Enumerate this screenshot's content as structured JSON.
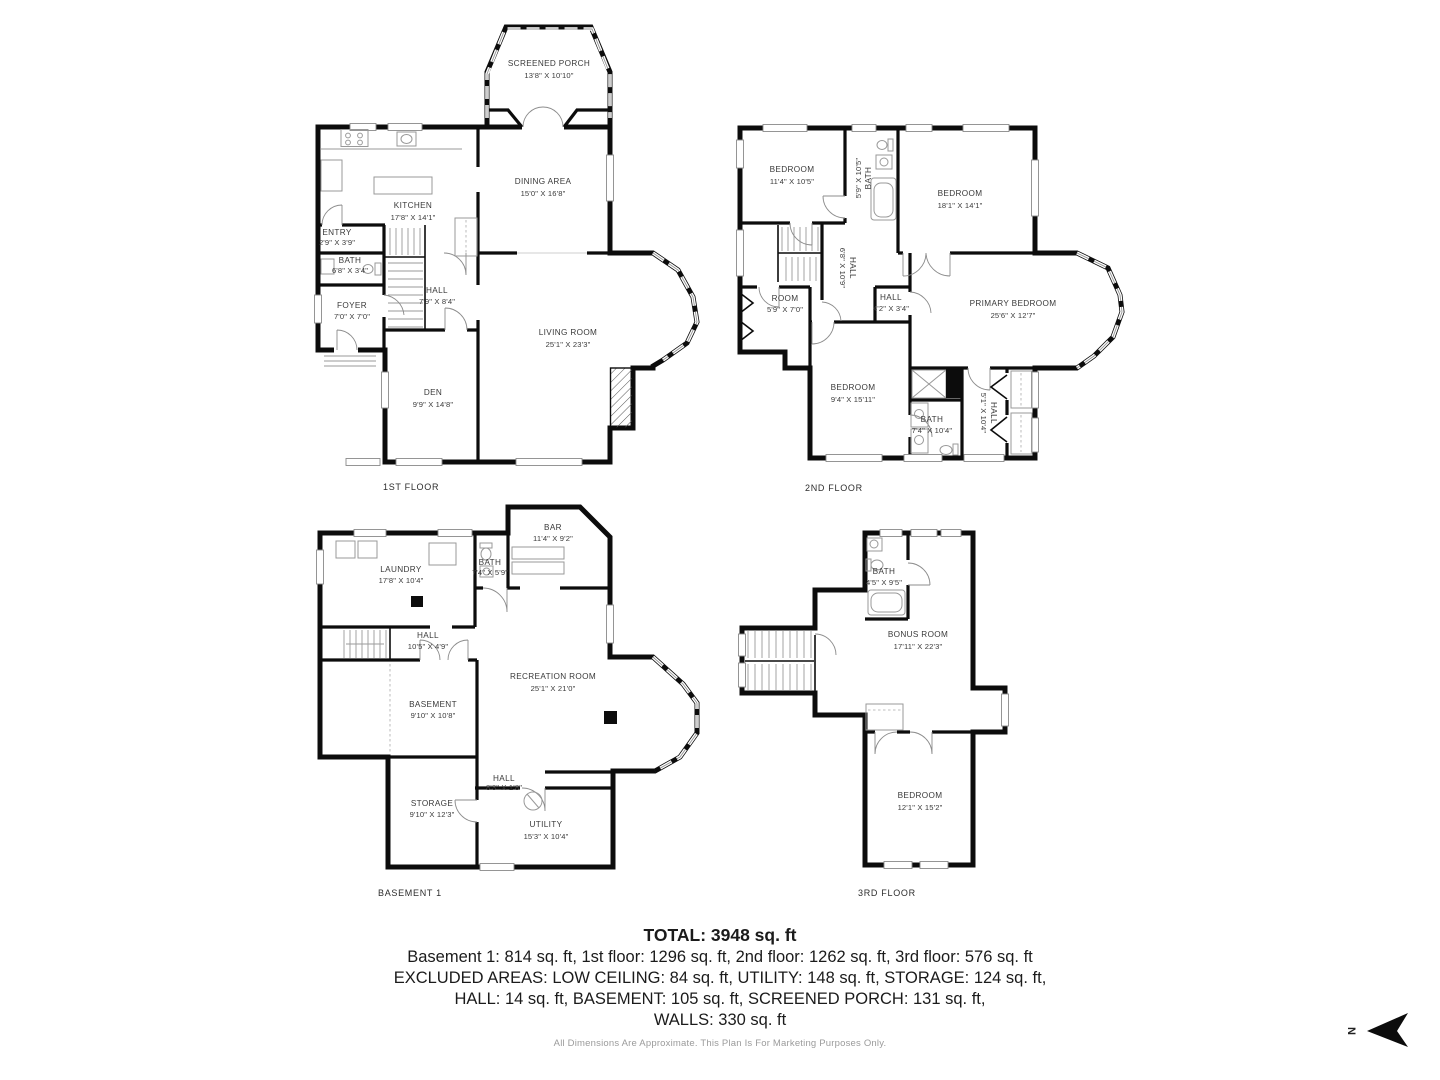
{
  "summary": {
    "total": "TOTAL: 3948 sq. ft",
    "areas": "Basement 1: 814 sq. ft, 1st floor: 1296 sq. ft, 2nd floor: 1262 sq. ft, 3rd floor: 576 sq. ft",
    "excluded1": "EXCLUDED AREAS: LOW CEILING: 84 sq. ft, UTILITY: 148 sq. ft, STORAGE: 124 sq. ft,",
    "excluded2": "HALL: 14 sq. ft, BASEMENT: 105 sq. ft, SCREENED PORCH: 131 sq. ft,",
    "walls": "WALLS: 330 sq. ft",
    "disclaimer": "All Dimensions Are Approximate. This Plan Is For Marketing Purposes Only."
  },
  "compass": {
    "label": "N"
  },
  "floors": {
    "first": {
      "label": "1ST FLOOR",
      "rooms": {
        "screened_porch": {
          "name": "SCREENED PORCH",
          "dims": "13'8\" X 10'10\""
        },
        "kitchen": {
          "name": "KITCHEN",
          "dims": "17'8\" X 14'1\""
        },
        "dining": {
          "name": "DINING AREA",
          "dims": "15'0\" X 16'8\""
        },
        "entry": {
          "name": "ENTRY",
          "dims": "2'9\" X 3'9\""
        },
        "bath": {
          "name": "BATH",
          "dims": "6'8\" X 3'4\""
        },
        "foyer": {
          "name": "FOYER",
          "dims": "7'0\" X 7'0\""
        },
        "hall": {
          "name": "HALL",
          "dims": "7'9\" X 8'4\""
        },
        "living": {
          "name": "LIVING ROOM",
          "dims": "25'1\" X 23'3\""
        },
        "den": {
          "name": "DEN",
          "dims": "9'9\" X 14'8\""
        }
      }
    },
    "second": {
      "label": "2ND FLOOR",
      "rooms": {
        "bedroom1": {
          "name": "BEDROOM",
          "dims": "11'4\" X 10'5\""
        },
        "bath1": {
          "name": "BATH",
          "dims": "5'9\" X 10'5\""
        },
        "bedroom2": {
          "name": "BEDROOM",
          "dims": "18'1\" X 14'1\""
        },
        "hall1": {
          "name": "HALL",
          "dims": "6'8\" X 10'9\""
        },
        "room": {
          "name": "ROOM",
          "dims": "5'9\" X 7'0\""
        },
        "hall2": {
          "name": "HALL",
          "dims": "4'2\" X 3'4\""
        },
        "primary": {
          "name": "PRIMARY BEDROOM",
          "dims": "25'6\" X 12'7\""
        },
        "bedroom3": {
          "name": "BEDROOM",
          "dims": "9'4\" X 15'11\""
        },
        "bath2": {
          "name": "BATH",
          "dims": "7'4\" X 10'4\""
        },
        "hall3": {
          "name": "HALL",
          "dims": "5'1\" X 10'4\""
        }
      }
    },
    "basement": {
      "label": "BASEMENT 1",
      "rooms": {
        "bar": {
          "name": "BAR",
          "dims": "11'4\" X 9'2\""
        },
        "laundry": {
          "name": "LAUNDRY",
          "dims": "17'8\" X 10'4\""
        },
        "bath": {
          "name": "BATH",
          "dims": "7'4\" X 5'9\""
        },
        "hall1": {
          "name": "HALL",
          "dims": "10'5\" X 4'9\""
        },
        "recreation": {
          "name": "RECREATION ROOM",
          "dims": "25'1\" X 21'0\""
        },
        "basement": {
          "name": "BASEMENT",
          "dims": "9'10\" X 10'8\""
        },
        "storage": {
          "name": "STORAGE",
          "dims": "9'10\" X 12'3\""
        },
        "hall2": {
          "name": "HALL",
          "dims": "8'3\" X 1'8\""
        },
        "utility": {
          "name": "UTILITY",
          "dims": "15'3\" X 10'4\""
        }
      }
    },
    "third": {
      "label": "3RD FLOOR",
      "rooms": {
        "bath": {
          "name": "BATH",
          "dims": "4'5\" X 9'5\""
        },
        "bonus": {
          "name": "BONUS ROOM",
          "dims": "17'11\" X 22'3\""
        },
        "bedroom": {
          "name": "BEDROOM",
          "dims": "12'1\" X 15'2\""
        }
      }
    }
  }
}
